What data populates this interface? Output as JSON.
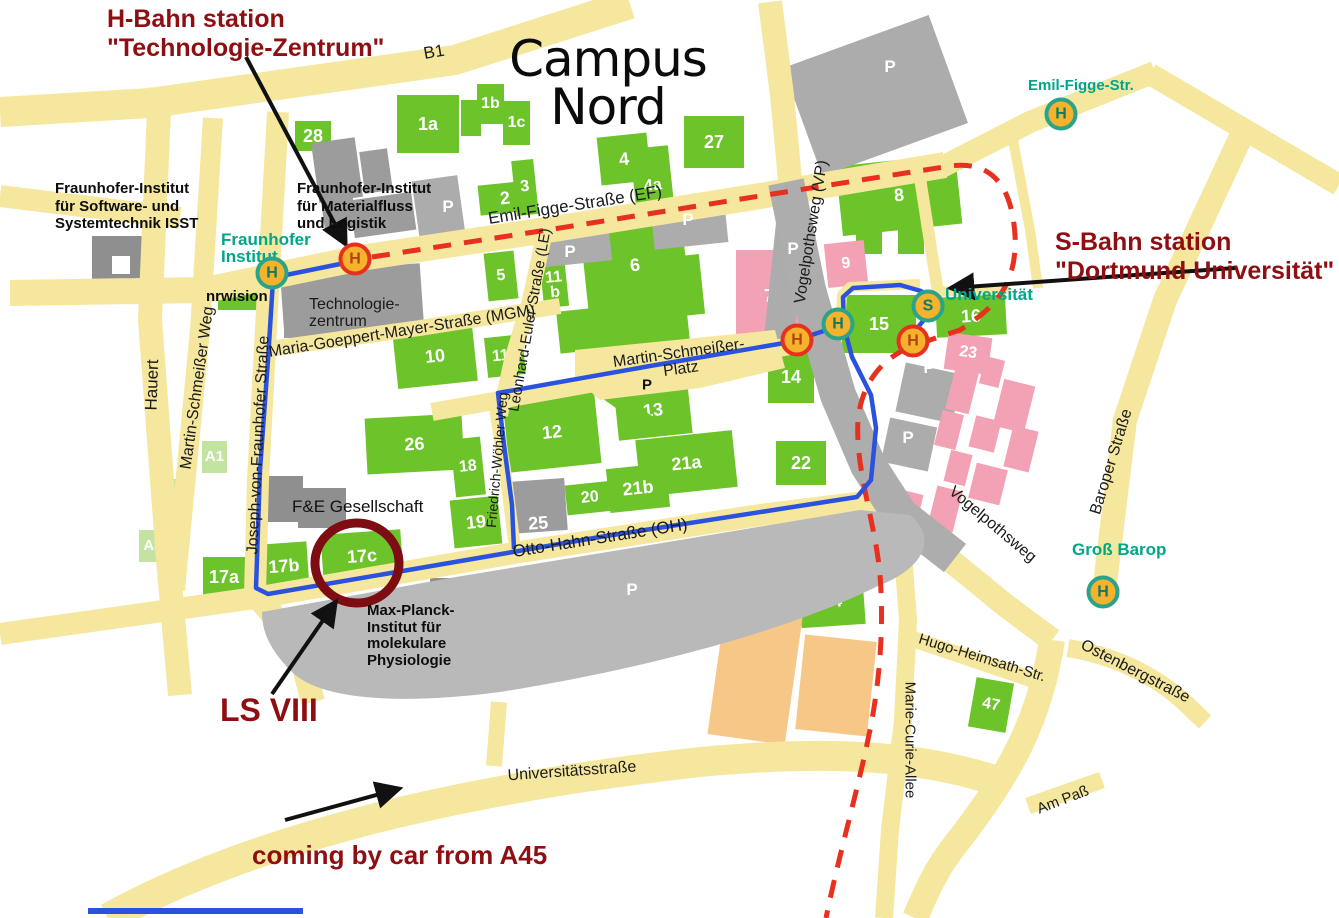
{
  "title": "Campus\nNord",
  "annotations": {
    "hbahn_station": "H-Bahn station\n\"Technologie-Zentrum\"",
    "sbahn_station": "S-Bahn station\n\"Dortmund Universität\"",
    "ls_viii": "LS VIII",
    "car": "coming by car from A45"
  },
  "institutions": {
    "isst": "Fraunhofer-Institut\nfür Software- und\nSystemtechnik ISST",
    "iml": "Fraunhofer-Institut\nfür Materialfluss\nund Logistik",
    "fraunhofer_stop": "Fraunhofer\nInstitut",
    "nrwision": "nrwision",
    "technologiezentrum": "Technologie-\nzentrum",
    "fe_gesellschaft": "F&E Gesellschaft",
    "max_planck": "Max-Planck-\nInstitut für\nmolekulare\nPhysiologie"
  },
  "stops": {
    "emil_figge": "Emil-Figge-Str.",
    "universitaet": "Universität",
    "gross_barop": "Groß Barop"
  },
  "streets": [
    "B1",
    "Emil-Figge-Straße (EF)",
    "Maria-Goeppert-Mayer-Straße (MGM)",
    "Leonhard-Euler-Straße (LE)",
    "Vogelpothsweg (VP)",
    "Martin-Schmeißer-\nPlatz",
    "Martin-Schmeißer Weg",
    "Hauert",
    "Joseph-von-Fraunhofer Straße",
    "Friedrich-Wöhler Weg",
    "Otto-Hahn-Straße (OH)",
    "Vogelpothsweg",
    "Baroper Straße",
    "Ostenbergstraße",
    "Hugo-Heimsath-Str.",
    "Marie-Curie-Allee",
    "Am Paß",
    "Universitätsstraße"
  ],
  "buildings": [
    "28",
    "1a",
    "1b",
    "1c",
    "2",
    "3",
    "4",
    "4a",
    "27",
    "8",
    "5",
    "11\nb",
    "6\na",
    "6",
    "7",
    "9",
    "10",
    "11a",
    "15",
    "16",
    "23",
    "14",
    "13",
    "12",
    "26",
    "18",
    "21a",
    "21b",
    "20",
    "22",
    "19",
    "17a",
    "17b",
    "17c",
    "24",
    "47",
    "A1",
    "A2",
    "A3",
    "25"
  ],
  "stations": [
    "H",
    "H",
    "H",
    "S",
    "H",
    "H",
    "H",
    "H"
  ],
  "parking_label": "P",
  "colors": {
    "accent_teal": "#00A68A",
    "dark_red": "#8E0E12",
    "route_blue": "#2B52DE",
    "hbahn_red": "#E8301F",
    "road_yellow": "#F5E79E",
    "building_green": "#6CC32A"
  }
}
